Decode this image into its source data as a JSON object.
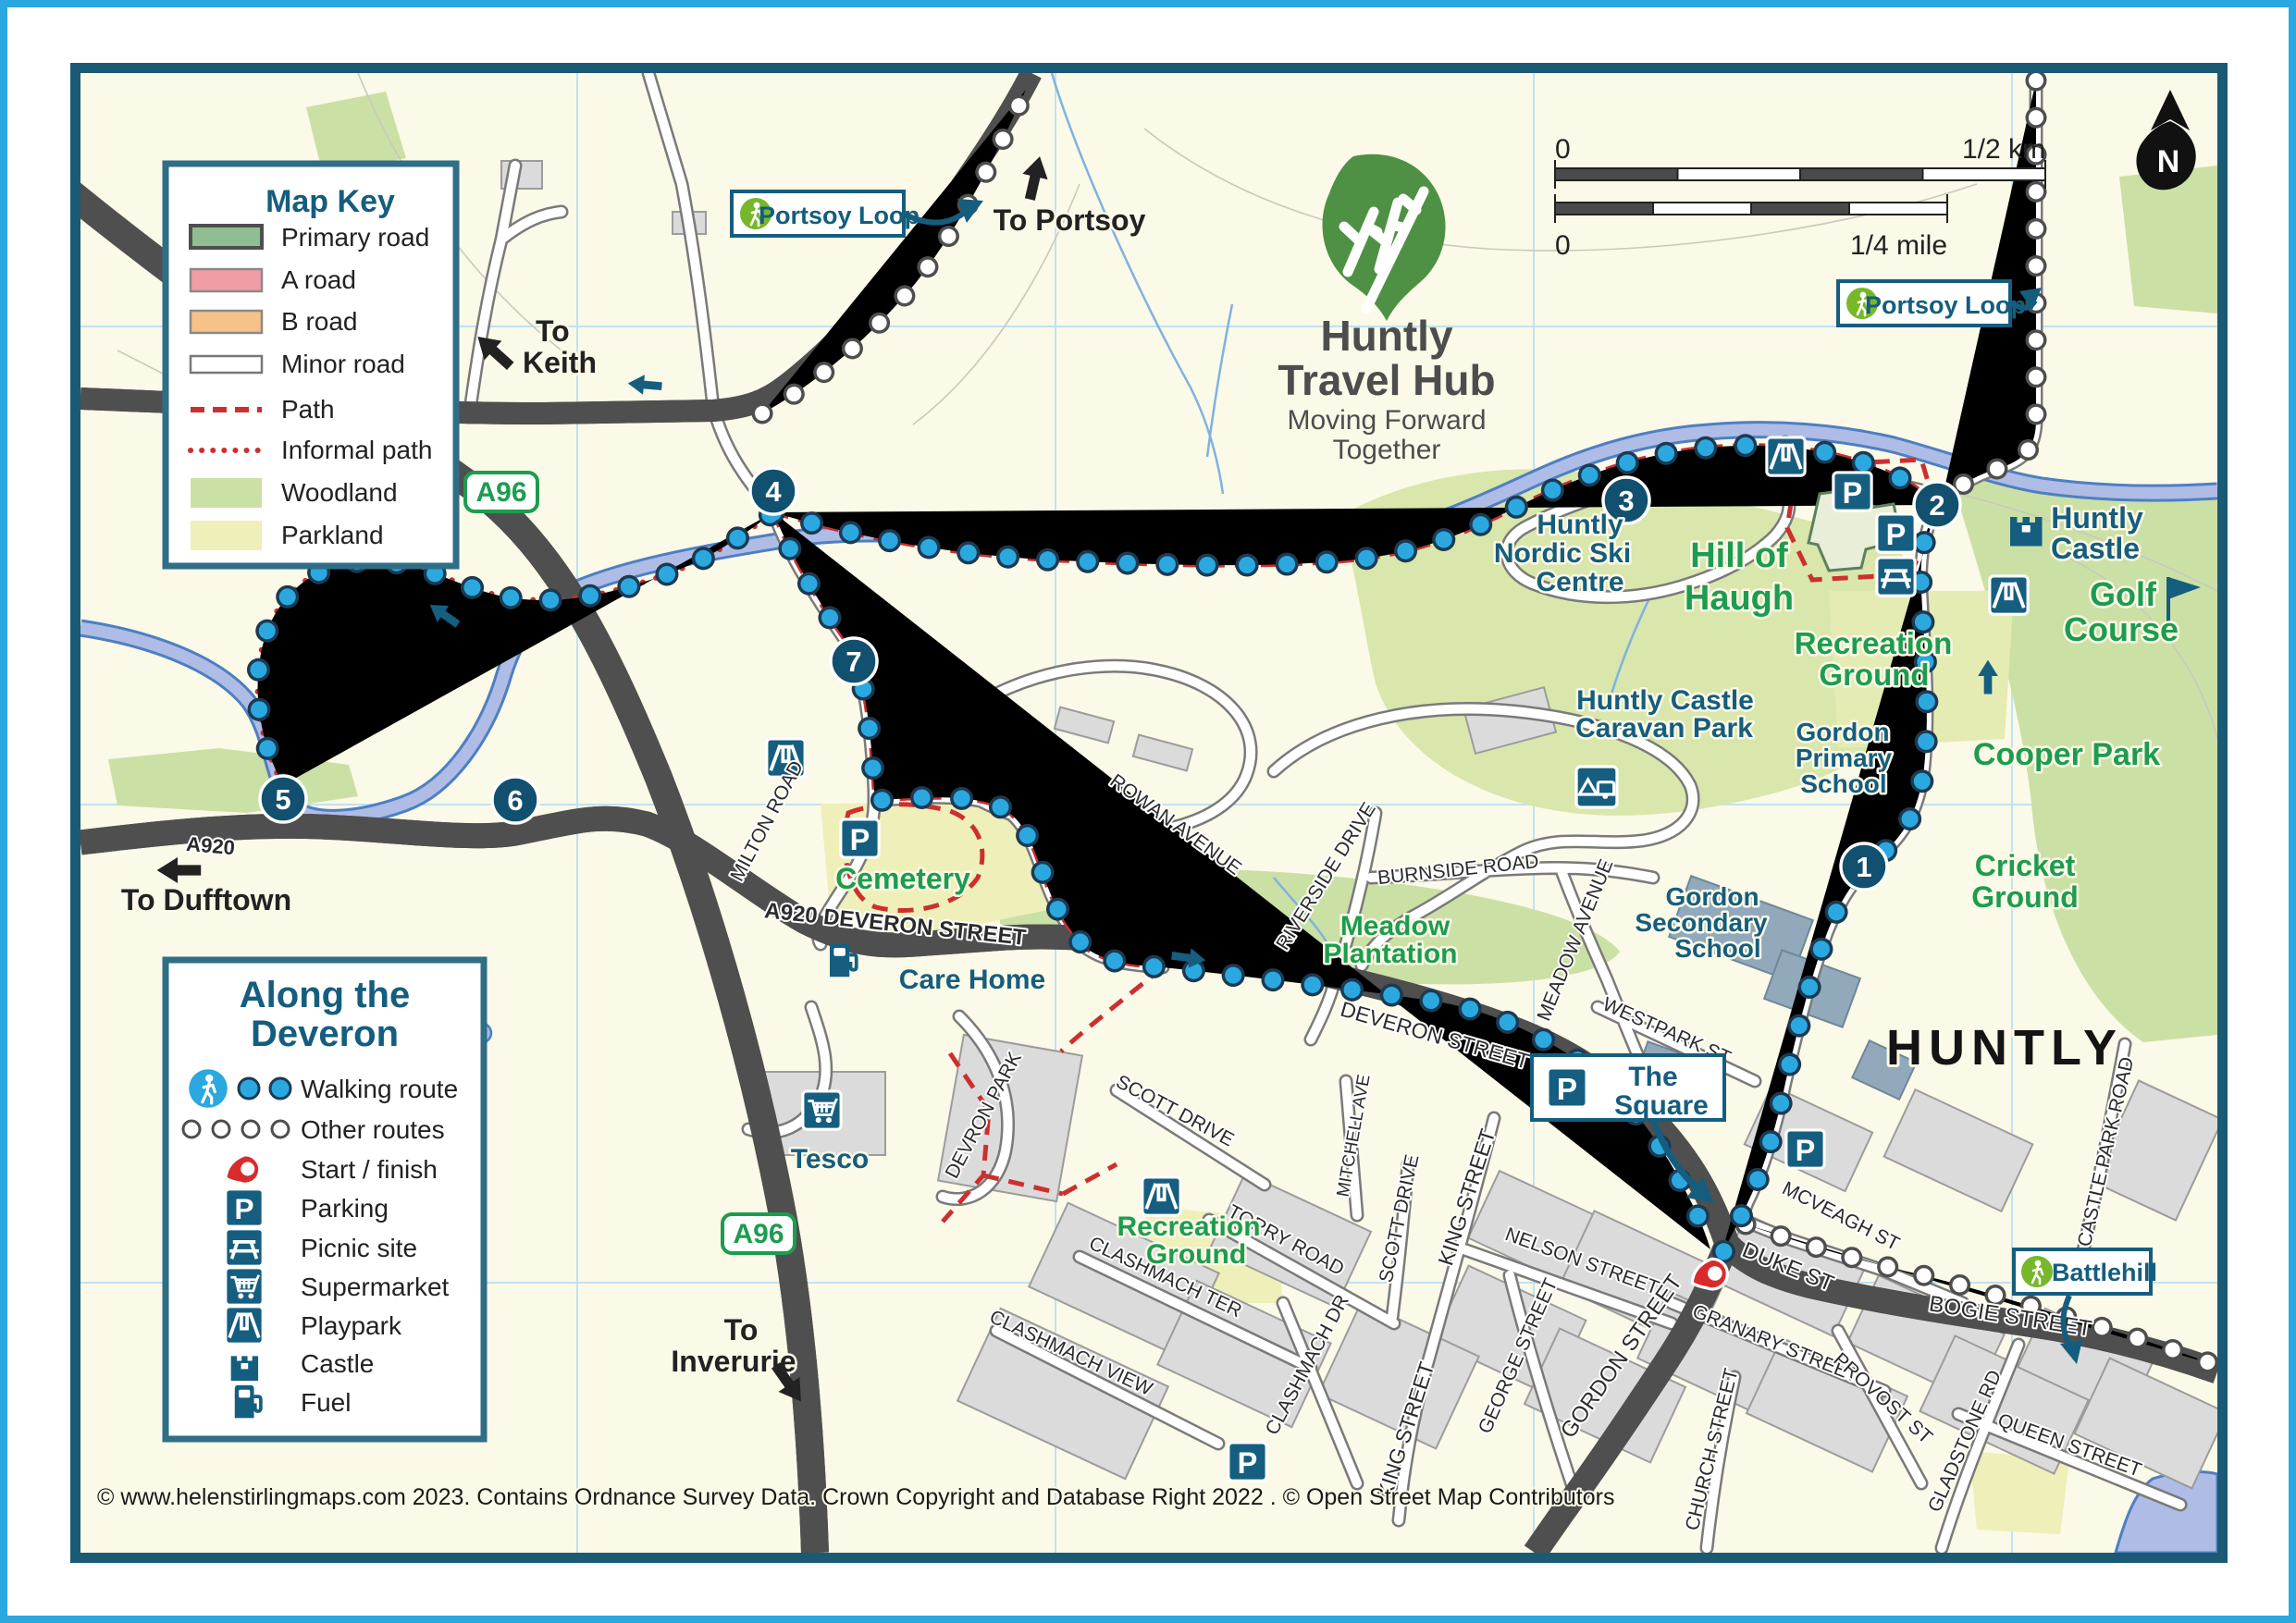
{
  "logo": {
    "title1": "Huntly",
    "title2": "Travel Hub",
    "tag1": "Moving Forward",
    "tag2": "Together"
  },
  "map_key": {
    "title": "Map Key",
    "items": [
      "Primary road",
      "A road",
      "B road",
      "Minor road",
      "Path",
      "Informal path",
      "Woodland",
      "Parkland"
    ]
  },
  "route_key": {
    "title1": "Along the",
    "title2": "Deveron",
    "items": [
      "Walking route",
      "Other routes",
      "Start / finish",
      "Parking",
      "Picnic site",
      "Supermarket",
      "Playpark",
      "Castle",
      "Fuel"
    ]
  },
  "scale": {
    "km_zero": "0",
    "km_label": "1/2 km",
    "mile_zero": "0",
    "mile_label": "1/4 mile"
  },
  "compass": {
    "n": "N"
  },
  "directions": {
    "portsoy": "To Portsoy",
    "keith1": "To",
    "keith2": "Keith",
    "dufftown": "To Dufftown",
    "inverurie1": "To",
    "inverurie2": "Inverurie"
  },
  "route_labels": {
    "portsoy_loop": "Portsoy Loop",
    "portsoy_loop2": "Portsoy Loop",
    "battlehill": "Battlehill",
    "square1": "The",
    "square2": "Square"
  },
  "road_refs": {
    "a96": "A96",
    "a96_south": "A96",
    "a920": "A920",
    "a920_deveron": "A920  DEVERON STREET"
  },
  "places": {
    "hill1": "Hill of",
    "hill2": "Haugh",
    "rec_ne1": "Recreation",
    "rec_ne2": "Ground",
    "golf1": "Golf",
    "golf2": "Course",
    "cooper": "Cooper Park",
    "cricket1": "Cricket",
    "cricket2": "Ground",
    "meadow1": "Meadow",
    "meadow2": "Plantation",
    "cemetery": "Cemetery",
    "rec_sw1": "Recreation",
    "rec_sw2": "Ground",
    "ski1": "Huntly",
    "ski2": "Nordic Ski",
    "ski3": "Centre",
    "caravan1": "Huntly Castle",
    "caravan2": "Caravan Park",
    "gps1": "Gordon",
    "gps2": "Primary",
    "gps3": "School",
    "gss1": "Gordon",
    "gss2": "Secondary",
    "gss3": "School",
    "castle1": "Huntly",
    "castle2": "Castle",
    "care_home": "Care Home",
    "tesco": "Tesco",
    "huntly": "HUNTLY"
  },
  "streets": {
    "milton": "MILTON ROAD",
    "rowan": "ROWAN AVENUE",
    "riverside": "RIVERSIDE DRIVE",
    "burnside": "BURNSIDE ROAD",
    "meadow_ave": "MEADOW AVENUE",
    "westpark": "WESTPARK ST",
    "deveron": "DEVERON STREET",
    "king_upper": "KING STREET",
    "king_lower": "KING STREET",
    "nelson": "NELSON STREET",
    "george": "GEORGE STREET",
    "gordon": "GORDON STREET",
    "granary": "GRANARY STREET",
    "church": "CHURCH STREET",
    "provost": "PROVOST ST",
    "mcveagh": "MCVEAGH ST",
    "duke": "DUKE ST",
    "bogie": "BOGIE STREET",
    "gladstone": "GLADSTONE RD",
    "queen": "QUEEN STREET",
    "castle_park": "CASTLE PARK ROAD",
    "torry": "TORRY ROAD",
    "clash_ter": "CLASHMACH TER",
    "clash_view": "CLASHMACH VIEW",
    "clash_dr": "CLASHMACH DR",
    "scott": "SCOTT DRIVE",
    "scott2": "SCOTT DRIVE",
    "mitchell": "MITCHELL AVE",
    "devron_park": "DEVRON PARK"
  },
  "waypoints": [
    "1",
    "2",
    "3",
    "4",
    "5",
    "6",
    "7"
  ],
  "icons": {
    "parking_letter": "P"
  },
  "copyright": "© www.helenstirlingmaps.com 2023. Contains Ordnance Survey Data. Crown Copyright and Database Right 2022 . © Open Street Map Contributors"
}
